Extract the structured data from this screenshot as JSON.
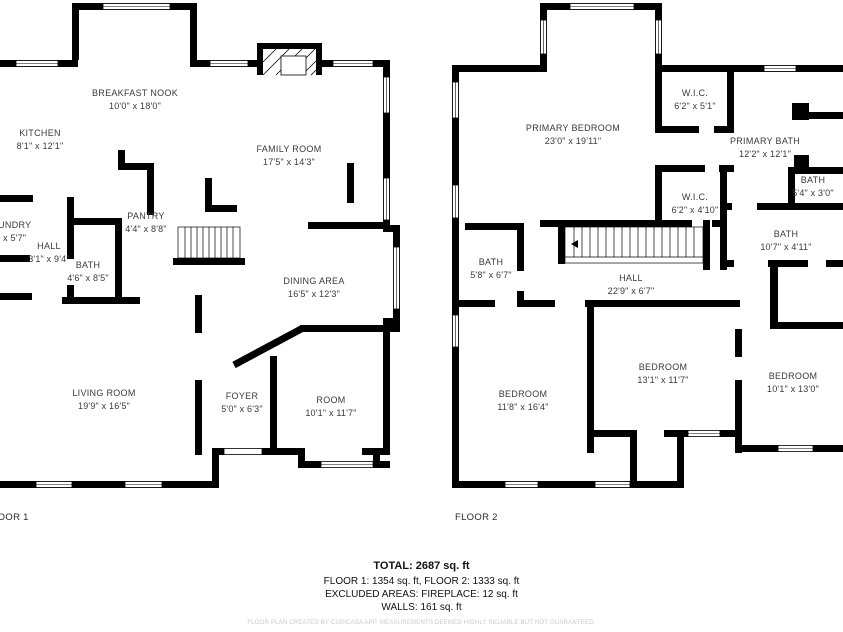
{
  "floor1": {
    "caption": "FLOOR 1",
    "rooms": [
      {
        "name": "BREAKFAST NOOK",
        "dims": "10'0\" x 18'0\""
      },
      {
        "name": "KITCHEN",
        "dims": "8'1\" x 12'1\""
      },
      {
        "name": "FAMILY ROOM",
        "dims": "17'5\" x 14'3\""
      },
      {
        "name": "LAUNDRY",
        "dims": "1\" x 5'7\""
      },
      {
        "name": "HALL",
        "dims": "3'1\" x 9'4\""
      },
      {
        "name": "PANTRY",
        "dims": "4'4\" x 8'8\""
      },
      {
        "name": "BATH",
        "dims": "4'6\" x 8'5\""
      },
      {
        "name": "DINING AREA",
        "dims": "16'5\" x 12'3\""
      },
      {
        "name": "LIVING ROOM",
        "dims": "19'9\" x 16'5\""
      },
      {
        "name": "FOYER",
        "dims": "5'0\" x 6'3\""
      },
      {
        "name": "ROOM",
        "dims": "10'1\" x 11'7\""
      }
    ]
  },
  "floor2": {
    "caption": "FLOOR 2",
    "rooms": [
      {
        "name": "PRIMARY BEDROOM",
        "dims": "23'0\" x 19'11\""
      },
      {
        "name": "W.I.C.",
        "dims": "6'2\" x 5'1\""
      },
      {
        "name": "PRIMARY BATH",
        "dims": "12'2\" x 12'1\""
      },
      {
        "name": "BATH",
        "dims": "5'4\" x 3'0\""
      },
      {
        "name": "W.I.C.",
        "dims": "6'2\" x 4'10\""
      },
      {
        "name": "BATH",
        "dims": "10'7\" x 4'11\""
      },
      {
        "name": "BATH",
        "dims": "5'8\" x 6'7\""
      },
      {
        "name": "HALL",
        "dims": "22'9\" x 6'7\""
      },
      {
        "name": "BEDROOM",
        "dims": "11'8\" x 16'4\""
      },
      {
        "name": "BEDROOM",
        "dims": "13'1\" x 11'7\""
      },
      {
        "name": "BEDROOM",
        "dims": "10'1\" x 13'0\""
      }
    ]
  },
  "summary": {
    "total": "TOTAL: 2687 sq. ft",
    "floors": "FLOOR 1: 1354 sq. ft, FLOOR 2: 1333 sq. ft",
    "excluded": "EXCLUDED AREAS: FIREPLACE: 12 sq. ft",
    "walls": "WALLS: 161 sq. ft"
  },
  "disclaimer": "FLOOR PLAN CREATED BY CUBICASA APP. MEASUREMENTS DEEMED HIGHLY RELIABLE BUT NOT GUARANTEED.",
  "colors": {
    "wall": "#000000",
    "background": "#ffffff",
    "label": "#3a3a3a",
    "disclaimer": "#c9c9c9"
  }
}
